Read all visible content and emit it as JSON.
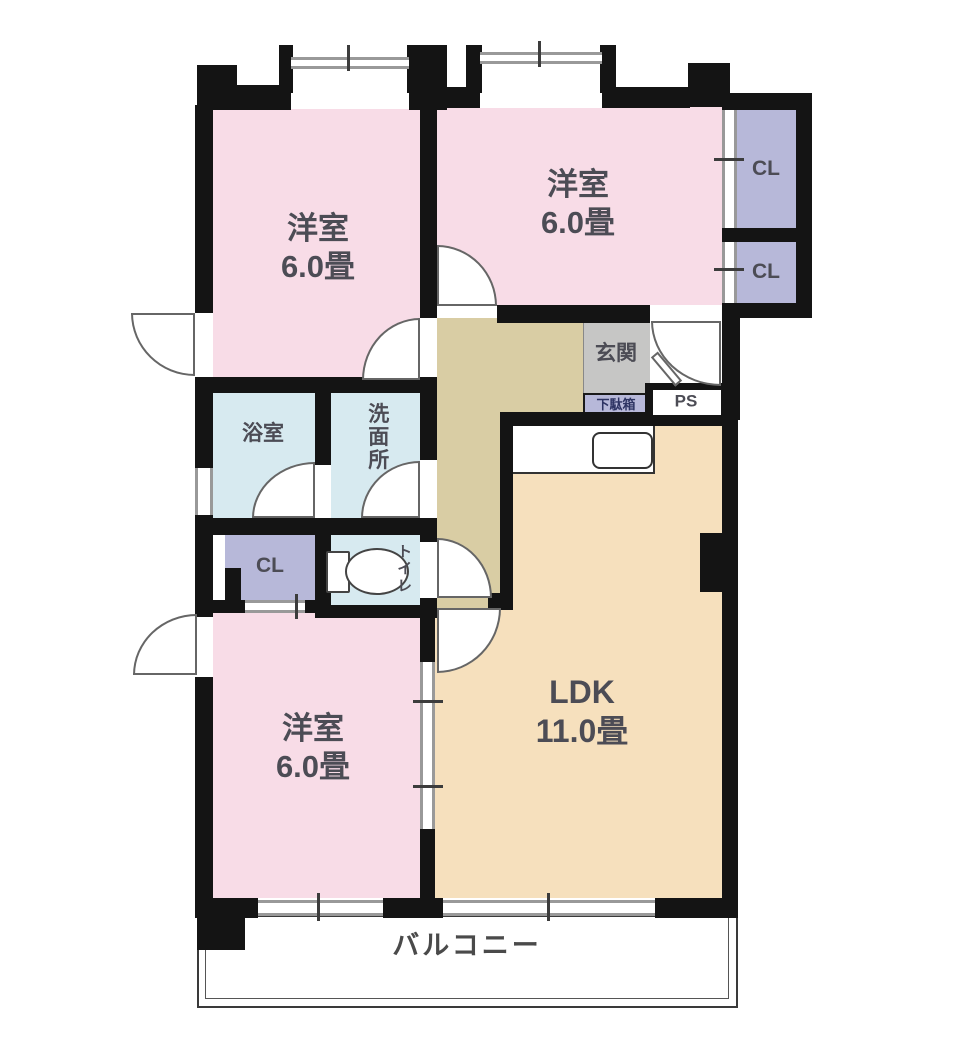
{
  "rooms": {
    "bedroom_top_left": {
      "name": "洋室",
      "size": "6.0畳"
    },
    "bedroom_top_right": {
      "name": "洋室",
      "size": "6.0畳"
    },
    "bedroom_bottom_left": {
      "name": "洋室",
      "size": "6.0畳"
    },
    "ldk": {
      "name": "LDK",
      "size": "11.0畳"
    },
    "bathroom": {
      "name": "浴室"
    },
    "washroom": {
      "name": "洗面所"
    },
    "toilet": {
      "name": "トイレ"
    },
    "closet_hall": {
      "name": "CL"
    },
    "closet_upper": {
      "name": "CL"
    },
    "closet_lower": {
      "name": "CL"
    },
    "entrance": {
      "name": "玄関"
    },
    "shoe_cabinet": {
      "name": "下駄箱"
    },
    "pipe_space": {
      "name": "PS"
    },
    "balcony": {
      "name": "バルコニー"
    }
  },
  "colors": {
    "wall": "#141414",
    "bedroom_pink": "#f8dce7",
    "ldk_tan": "#f6e0bd",
    "corridor_khaki": "#d9cda4",
    "wet_area_blue": "#d7eaf0",
    "closet_lavender": "#b7b8d9",
    "entrance_gray": "#c6c6c5",
    "window_gray": "#999999",
    "text": "#4c4c55"
  }
}
